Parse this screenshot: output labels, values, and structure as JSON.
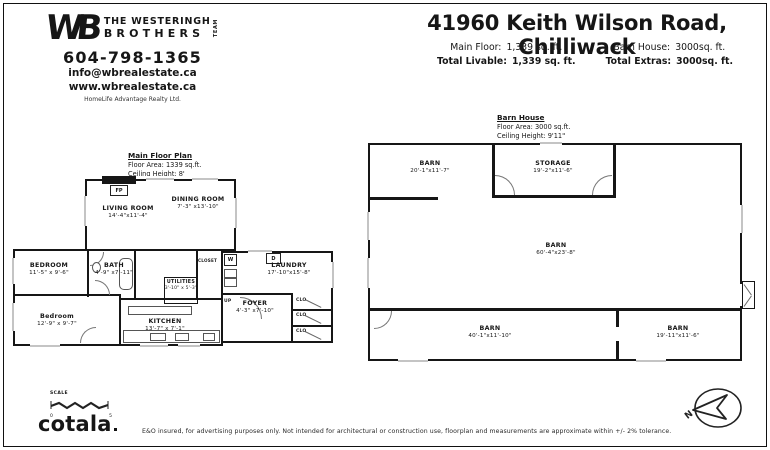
{
  "header": {
    "title": "41960 Keith Wilson Road, Chilliwack",
    "stats": [
      {
        "label": "Main Floor:",
        "value": "1,339 sq. ft."
      },
      {
        "label": "Total Livable:",
        "value": "1,339 sq. ft."
      },
      {
        "label": "Barn House:",
        "value": "3000sq. ft."
      },
      {
        "label": "Total Extras:",
        "value": "3000sq. ft."
      }
    ]
  },
  "brand": {
    "logo_wb": "WB",
    "logo_line1": "THE WESTERINGH",
    "logo_line2": "BROTHERS",
    "logo_team": "TEAM",
    "phone": "604-798-1365",
    "email": "info@wbrealestate.ca",
    "website": "www.wbrealestate.ca",
    "brokerage": "HomeLife Advantage Realty Ltd."
  },
  "main_plan": {
    "title": "Main Floor Plan",
    "area": "Floor Area: 1339 sq.ft.",
    "ceiling": "Ceiling Height: 8'",
    "rooms": {
      "living": {
        "name": "LIVING ROOM",
        "dims": "14'-4\"x11'-4\""
      },
      "dining": {
        "name": "DINING ROOM",
        "dims": "7'-3\" x13'-10\""
      },
      "bedroom1": {
        "name": "BEDROOM",
        "dims": "11'-5\" x 9'-6\""
      },
      "bath": {
        "name": "BATH",
        "dims": "4'-9\" x7'-11\""
      },
      "bedroom2": {
        "name": "Bedroom",
        "dims": "12'-9\" x 9'-7\""
      },
      "utilities": {
        "name": "UTILITIES",
        "dims": "3'-10\" x 5'-3\""
      },
      "kitchen": {
        "name": "KITCHEN",
        "dims": "13'-7\" x 7'-1\""
      },
      "foyer": {
        "name": "FOYER",
        "dims": "4'-3\" x7'-10\""
      },
      "laundry": {
        "name": "LAUNDRY",
        "dims": "17'-10\"x15'-8\""
      }
    },
    "marks": {
      "fireplace": "FP",
      "washer": "W",
      "dryer": "D",
      "closet": "CLOSET",
      "clo": "CLO",
      "up": "UP"
    }
  },
  "barn_plan": {
    "title": "Barn House",
    "area": "Floor Area: 3000 sq.ft.",
    "ceiling": "Ceiling Height: 9'11\"",
    "rooms": {
      "barn_nw": {
        "name": "BARN",
        "dims": "20'-1\"x11'-7\""
      },
      "storage": {
        "name": "STORAGE",
        "dims": "19'-2\"x11'-6\""
      },
      "barn_main": {
        "name": "BARN",
        "dims": "60'-4\"x23'-8\""
      },
      "barn_sw": {
        "name": "BARN",
        "dims": "40'-1\"x11'-10\""
      },
      "barn_se": {
        "name": "BARN",
        "dims": "19'-11\"x11'-6\""
      }
    }
  },
  "footer": {
    "scale_label": "SCALE",
    "scale_zero": "0",
    "scale_five": "5",
    "compass_n": "N",
    "logo": "cotala",
    "disclaimer": "E&O insured, for advertising purposes only. Not intended for architectural or construction use, floorplan and measurements are approximate within +/- 2% tolerance."
  }
}
